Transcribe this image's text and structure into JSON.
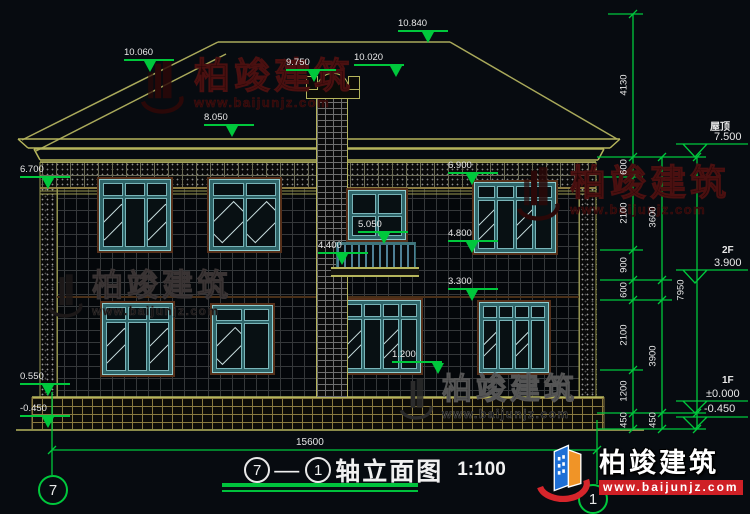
{
  "watermark": {
    "brand": "柏竣建筑",
    "url": "www.baijunjz.com"
  },
  "logo": {
    "brand": "柏竣建筑",
    "url": "www.baijunjz.com"
  },
  "title": {
    "axis_a": "7",
    "dash": "—",
    "axis_b": "1",
    "name": "轴立面图",
    "scale": "1:100"
  },
  "bubbles": {
    "left": "7",
    "right": "1"
  },
  "elev": {
    "ridge": "10.840",
    "roof_left": "10.060",
    "chimney_top": "10.020",
    "chimney_cap": "9.750",
    "eave": "8.050",
    "frieze_left": "6.700",
    "frieze_right": "6.900",
    "balcony_rail": "5.050",
    "balcony_slab": "4.400",
    "sill_2f": "4.800",
    "lintel_1f": "3.300",
    "sill_1f": "1.200",
    "plinth": "0.550",
    "ground_left": "-0.450"
  },
  "levels": {
    "roof_label": "屋顶",
    "roof_value": "7.500",
    "f2_label": "2F",
    "f2_value": "3.900",
    "f1_label": "1F",
    "f1_zero": "±0.000",
    "f1_neg": "-0.450"
  },
  "vdims": {
    "col_a": [
      "4130",
      "600",
      "2100",
      "900",
      "600",
      "2100",
      "1200",
      "450"
    ],
    "col_b": [
      "3600",
      "3900",
      "450"
    ],
    "col_c": [
      "7950"
    ]
  },
  "hdim": {
    "total": "15600"
  }
}
